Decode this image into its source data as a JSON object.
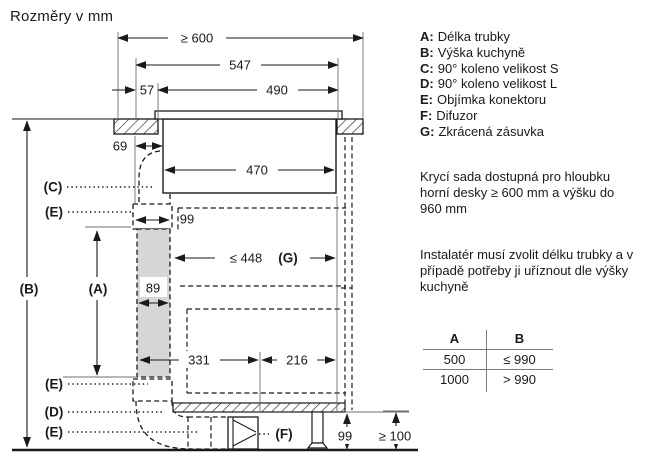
{
  "title": "Rozměry v mm",
  "legend": {
    "items": [
      {
        "key": "A:",
        "label": "Délka trubky"
      },
      {
        "key": "B:",
        "label": "Výška kuchyně"
      },
      {
        "key": "C:",
        "label": "90° koleno velikost S"
      },
      {
        "key": "D:",
        "label": "90° koleno velikost L"
      },
      {
        "key": "E:",
        "label": "Objímka konektoru"
      },
      {
        "key": "F:",
        "label": "Difuzor"
      },
      {
        "key": "G:",
        "label": "Zkrácená zásuvka"
      }
    ]
  },
  "notes": {
    "note1": "Krycí sada dostupná pro hloubku horní desky ≥ 600 mm a výšku do 960 mm",
    "note2": "Instalatér musí zvolit délku trubky a v případě potřeby ji uříznout dle výšky kuchyně"
  },
  "table": {
    "headers": [
      "A",
      "B"
    ],
    "rows": [
      [
        "500",
        "≤ 990"
      ],
      [
        "1000",
        "> 990"
      ]
    ]
  },
  "diagram": {
    "dims": {
      "depth": "≥ 600",
      "plate": "547",
      "offset": "57",
      "cutout": "490",
      "hob": "470",
      "duct_offset": "69",
      "connector": "99",
      "duct_width": "89",
      "drawer_len": "≤ 448",
      "drawer_key": "(G)",
      "left_run": "331",
      "right_run": "216",
      "plinth_h": "99",
      "clearance": "≥ 100"
    },
    "labels": {
      "a": "(A)",
      "b": "(B)",
      "c": "(C)",
      "d": "(D)",
      "e": "(E)",
      "f": "(F)"
    }
  }
}
